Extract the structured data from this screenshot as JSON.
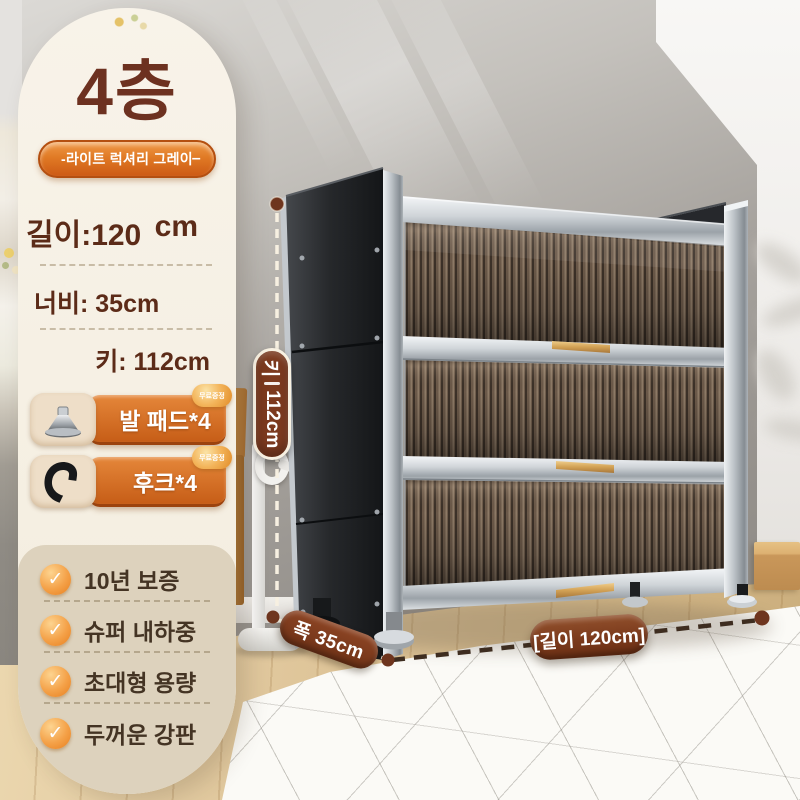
{
  "info_card": {
    "tier": "4층",
    "color_badge": "-라이트 럭셔리 그레이",
    "color_badge_dash": "–",
    "length_label": "길이:120",
    "length_unit": "cm",
    "width_label": "너비: 35cm",
    "height_label": "키: 112cm",
    "accessories": [
      {
        "label": "발 패드*4",
        "icon": "foot-pad-icon",
        "badge": "무료증정"
      },
      {
        "label": "후크*4",
        "icon": "hook-icon",
        "badge": "무료증정"
      }
    ],
    "features": [
      {
        "label": "10년 보증"
      },
      {
        "label": "슈퍼 내하중"
      },
      {
        "label": "초대형 용량"
      },
      {
        "label": "두꺼운 강판"
      }
    ]
  },
  "annotations": {
    "height_prefix": "키",
    "height_value": "112cm",
    "width": "폭 35cm",
    "length": "[길이 120cm]"
  },
  "colors": {
    "accent_orange": "#d96a1e",
    "pill_brown": "#7c3a1f",
    "text_brown": "#5c2b18",
    "card_cream": "#f6f0e4",
    "feature_panel_beige": "#ddd2bd",
    "cabinet_dark": "#232528",
    "cabinet_silver": "#c3c9ce",
    "door_flute_brown": "#6b5949"
  }
}
